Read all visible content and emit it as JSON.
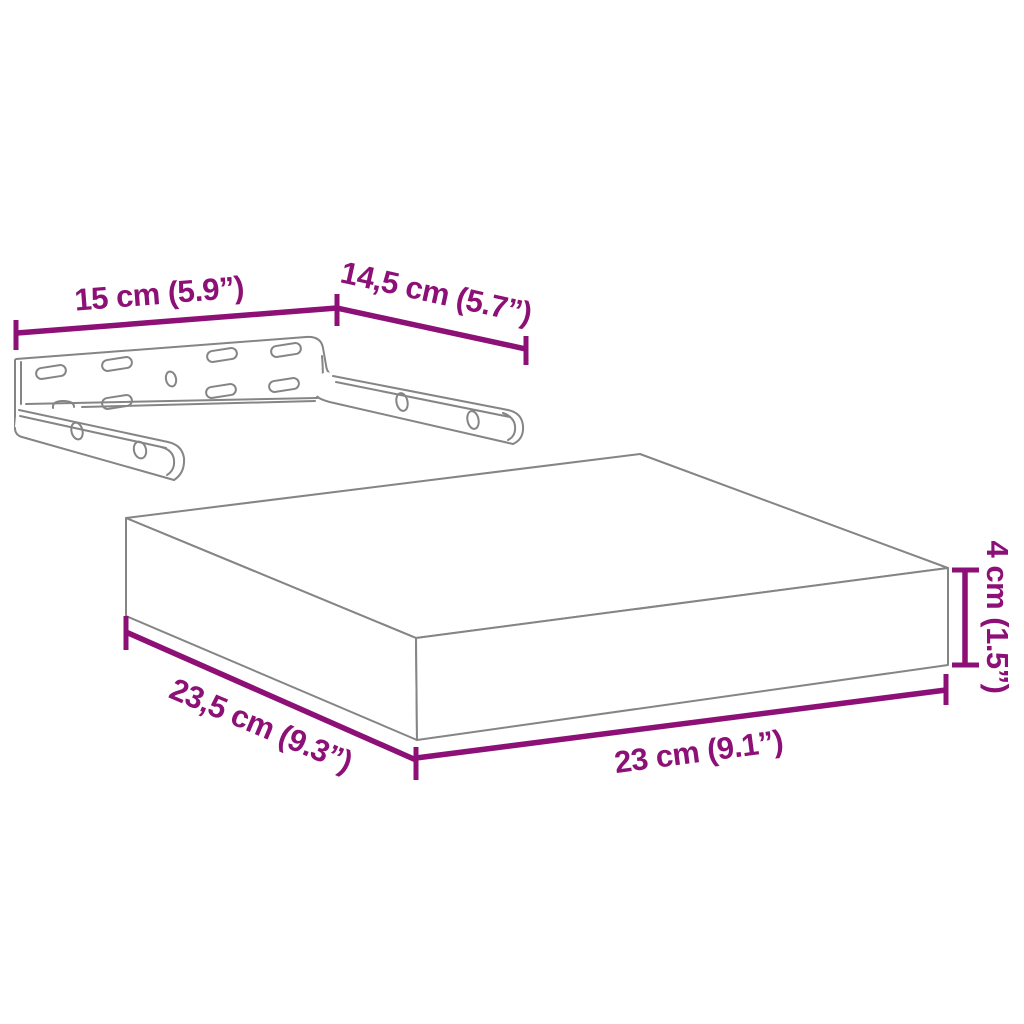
{
  "diagram": {
    "kind": "product dimension line-art",
    "subject": "floating wall shelf with mounting bracket",
    "colors": {
      "dimension_accent": "#8C1076",
      "line_art": "#858585",
      "background": "#FFFFFF"
    },
    "dimensions": {
      "bracket_width": "15 cm (5.9”)",
      "bracket_depth": "14,5 cm (5.7”)",
      "shelf_height": "4 cm (1.5”)",
      "shelf_depth": "23,5 cm (9.3”)",
      "shelf_width": "23 cm (9.1”)"
    }
  }
}
